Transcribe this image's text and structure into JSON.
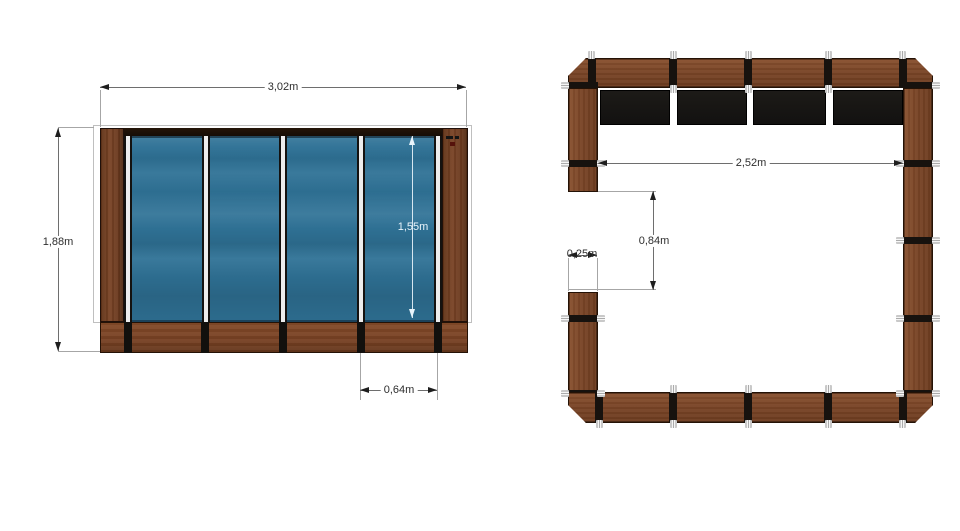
{
  "colors": {
    "background": "#ffffff",
    "wood": "#7a4527",
    "glass": "#2e7195",
    "joint_black": "#17120e",
    "dimension_text": "#2e2e2e",
    "glass_dimension_text": "#e9f4fb"
  },
  "elevation_view": {
    "glass_panel_count": 4,
    "dim_total_width": "3,02m",
    "dim_total_height": "1,88m",
    "dim_glass_height": "1,55m",
    "dim_panel_width": "0,64m"
  },
  "plan_view": {
    "dim_inner_width": "2,52m",
    "dim_opening_height": "0,84m",
    "dim_post_width": "0,25m"
  }
}
